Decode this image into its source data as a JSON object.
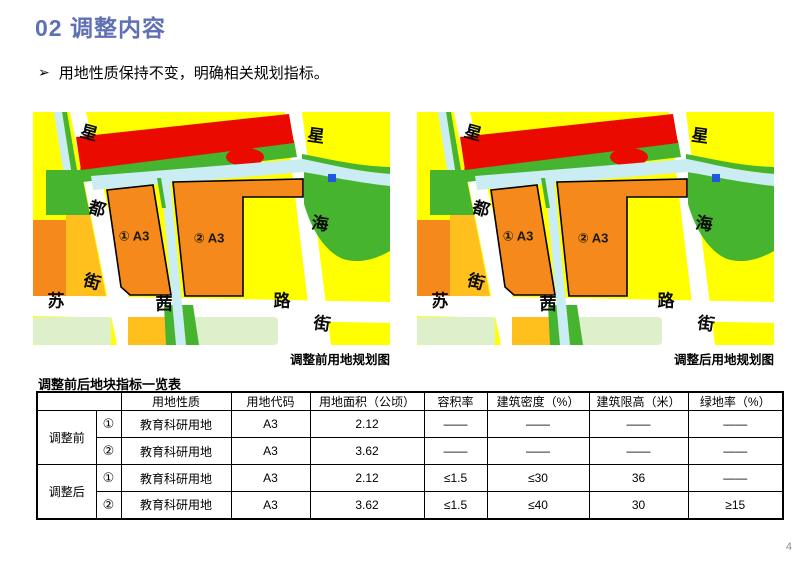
{
  "slide": {
    "title": "02 调整内容",
    "bullet_marker": "➢",
    "bullet_text": "用地性质保持不变，明确相关规划指标。",
    "page_number": "4"
  },
  "maps": {
    "before_caption": "调整前用地规划图",
    "after_caption": "调整后用地规划图",
    "labels": {
      "left_road": [
        "星",
        "都",
        "街"
      ],
      "right_road": [
        "星",
        "海",
        "街"
      ],
      "bottom_road": [
        "苏",
        "茜",
        "路"
      ],
      "parcel_1": "① A3",
      "parcel_2": "② A3"
    },
    "colors": {
      "land_yellow": "#FFFF00",
      "land_red": "#EB0A00",
      "land_green": "#46B42F",
      "water_cyan": "#C9EDF2",
      "parcel_orange": "#F6891C",
      "land_amber": "#FFC01E",
      "land_palegreen": "#DDF0CB",
      "marker_blue": "#2356E0",
      "road_white": "#FFFFFF",
      "parcel_border": "#000000"
    }
  },
  "table": {
    "title": "调整前后地块指标一览表",
    "headers": [
      "用地性质",
      "用地代码",
      "用地面积（公顷）",
      "容积率",
      "建筑密度（%）",
      "建筑限高（米）",
      "绿地率（%）"
    ],
    "groups": [
      {
        "label": "调整前",
        "rows": [
          {
            "num": "①",
            "nature": "教育科研用地",
            "code": "A3",
            "area": "2.12",
            "far": "——",
            "density": "——",
            "height_limit": "——",
            "green_rate": "——"
          },
          {
            "num": "②",
            "nature": "教育科研用地",
            "code": "A3",
            "area": "3.62",
            "far": "——",
            "density": "——",
            "height_limit": "——",
            "green_rate": "——"
          }
        ]
      },
      {
        "label": "调整后",
        "rows": [
          {
            "num": "①",
            "nature": "教育科研用地",
            "code": "A3",
            "area": "2.12",
            "far": "≤1.5",
            "density": "≤30",
            "height_limit": "36",
            "green_rate": "——"
          },
          {
            "num": "②",
            "nature": "教育科研用地",
            "code": "A3",
            "area": "3.62",
            "far": "≤1.5",
            "density": "≤40",
            "height_limit": "30",
            "green_rate": "≥15"
          }
        ]
      }
    ]
  }
}
